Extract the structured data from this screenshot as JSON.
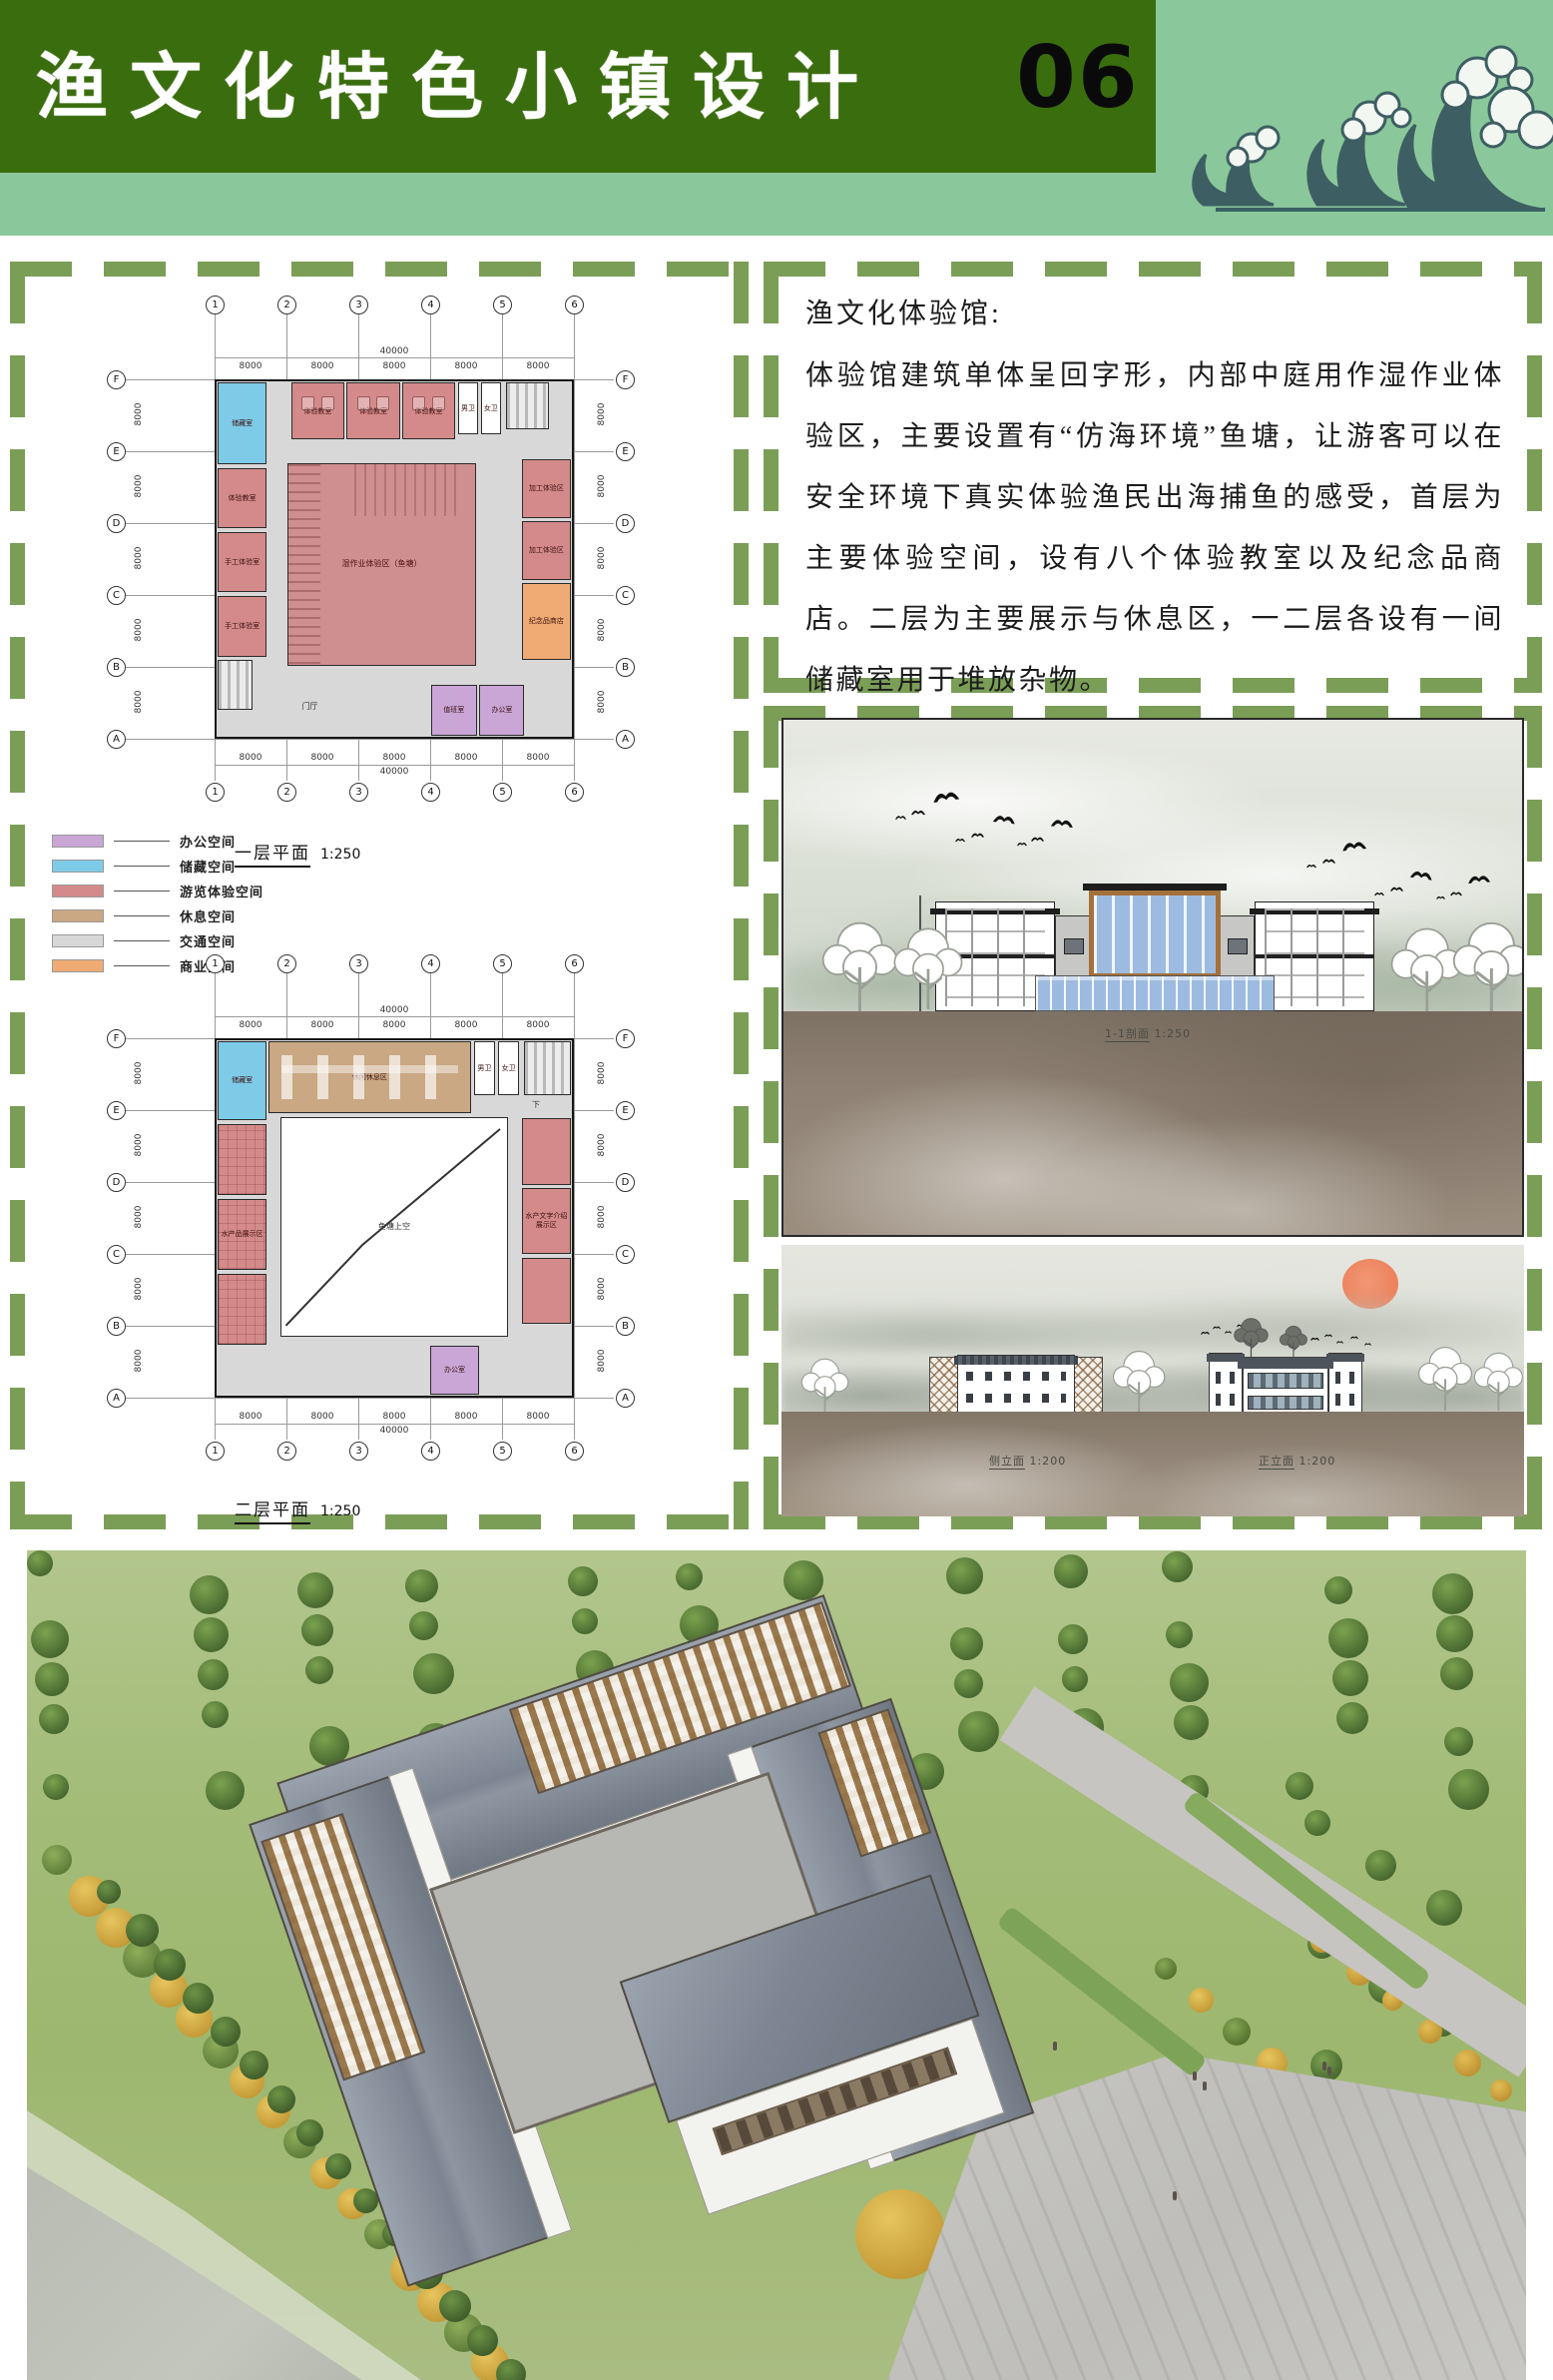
{
  "header": {
    "title": "渔文化特色小镇设计",
    "page_number": "06"
  },
  "colors": {
    "header_green": "#3a6d0e",
    "strip_green": "#8ac79a",
    "dash_green": "#7b9e57",
    "office": "#c9a6d6",
    "storage": "#7ecbe8",
    "tour": "#d48a8a",
    "rest": "#c9a883",
    "traffic": "#d8d8d8",
    "commerce": "#efab73",
    "pond": "#cf8e90",
    "wave_teal": "#3d5f63",
    "sun": "#ee7a52",
    "glass": "#9dbbe0",
    "wood": "#a4713c"
  },
  "left_panel": {
    "legend": {
      "items": [
        {
          "label": "办公空间",
          "type": "office"
        },
        {
          "label": "储藏空间",
          "type": "storage"
        },
        {
          "label": "游览体验空间",
          "type": "tour"
        },
        {
          "label": "休息空间",
          "type": "rest"
        },
        {
          "label": "交通空间",
          "type": "traffic"
        },
        {
          "label": "商业空间",
          "type": "commerce"
        }
      ]
    },
    "plans": [
      {
        "id": "plan1",
        "title": "一层平面",
        "scale": "1:250",
        "cols": [
          "1",
          "2",
          "3",
          "4",
          "5",
          "6"
        ],
        "rows": [
          "F",
          "E",
          "D",
          "C",
          "B",
          "A"
        ],
        "bay_dim": "8000",
        "total_dim": "40000",
        "extra_label": "门厅",
        "rooms": [
          {
            "x": 20,
            "y": 23,
            "w": 53,
            "h": 57,
            "type": "pond",
            "label": "湿作业体验区（鱼塘）"
          },
          {
            "x": 0.4,
            "y": 0.4,
            "w": 13.6,
            "h": 23,
            "type": "storage",
            "label": "储藏室"
          },
          {
            "x": 21,
            "y": 0.4,
            "w": 15,
            "h": 16,
            "type": "tour",
            "label": "体验教室",
            "cls": "classroom"
          },
          {
            "x": 36.6,
            "y": 0.4,
            "w": 15,
            "h": 16,
            "type": "tour",
            "label": "体验教室",
            "cls": "classroom"
          },
          {
            "x": 52.2,
            "y": 0.4,
            "w": 15,
            "h": 16,
            "type": "tour",
            "label": "体验教室",
            "cls": "classroom"
          },
          {
            "x": 68,
            "y": 0.4,
            "w": 5.6,
            "h": 14.6,
            "type": "wc",
            "label": "男卫"
          },
          {
            "x": 74.4,
            "y": 0.4,
            "w": 5.6,
            "h": 14.6,
            "type": "wc",
            "label": "女卫"
          },
          {
            "x": 81.4,
            "y": 0.4,
            "w": 12,
            "h": 13,
            "type": "stair",
            "label": ""
          },
          {
            "x": 0.4,
            "y": 24.4,
            "w": 13.6,
            "h": 17,
            "type": "tour",
            "label": "体验教室"
          },
          {
            "x": 0.4,
            "y": 42.4,
            "w": 13.6,
            "h": 17,
            "type": "tour",
            "label": "手工体验室"
          },
          {
            "x": 0.4,
            "y": 60.4,
            "w": 13.6,
            "h": 17,
            "type": "tour",
            "label": "手工体验室"
          },
          {
            "x": 0.4,
            "y": 78.4,
            "w": 9.6,
            "h": 14,
            "type": "stair",
            "label": ""
          },
          {
            "x": 86,
            "y": 22,
            "w": 13.6,
            "h": 16.4,
            "type": "tour",
            "label": "加工体验区"
          },
          {
            "x": 86,
            "y": 39.4,
            "w": 13.6,
            "h": 16.4,
            "type": "tour",
            "label": "加工体验区"
          },
          {
            "x": 86,
            "y": 56.8,
            "w": 13.6,
            "h": 21.6,
            "type": "commerce",
            "label": "纪念品商店"
          },
          {
            "x": 60.4,
            "y": 85.4,
            "w": 12.8,
            "h": 14.2,
            "type": "office",
            "label": "值班室"
          },
          {
            "x": 74,
            "y": 85.4,
            "w": 12.6,
            "h": 14.2,
            "type": "office",
            "label": "办公室"
          }
        ]
      },
      {
        "id": "plan2",
        "title": "二层平面",
        "scale": "1:250",
        "cols": [
          "1",
          "2",
          "3",
          "4",
          "5",
          "6"
        ],
        "rows": [
          "F",
          "E",
          "D",
          "C",
          "B",
          "A"
        ],
        "bay_dim": "8000",
        "total_dim": "40000",
        "extra_label": "下",
        "rooms": [
          {
            "x": 18,
            "y": 21.5,
            "w": 64,
            "h": 62,
            "type": "void",
            "label": "鱼塘上空",
            "diag": true
          },
          {
            "x": 0.4,
            "y": 0.4,
            "w": 13.6,
            "h": 22,
            "type": "storage",
            "label": "储藏室"
          },
          {
            "x": 14.6,
            "y": 0.4,
            "w": 57,
            "h": 20,
            "type": "rest",
            "label": "休闲休息区"
          },
          {
            "x": 72.4,
            "y": 0.4,
            "w": 6,
            "h": 15,
            "type": "wc",
            "label": "男卫"
          },
          {
            "x": 79.2,
            "y": 0.4,
            "w": 6,
            "h": 15,
            "type": "wc",
            "label": "女卫"
          },
          {
            "x": 86.4,
            "y": 0.4,
            "w": 13.2,
            "h": 15,
            "type": "stair",
            "label": ""
          },
          {
            "x": 0.4,
            "y": 23.6,
            "w": 13.6,
            "h": 20,
            "type": "tour",
            "label": "",
            "cls": "hatch"
          },
          {
            "x": 0.4,
            "y": 44.6,
            "w": 13.6,
            "h": 20,
            "type": "tour",
            "label": "水产品展示区",
            "cls": "hatch"
          },
          {
            "x": 0.4,
            "y": 65.6,
            "w": 13.6,
            "h": 20,
            "type": "tour",
            "label": "",
            "cls": "hatch"
          },
          {
            "x": 86,
            "y": 22,
            "w": 13.6,
            "h": 18.6,
            "type": "tour",
            "label": ""
          },
          {
            "x": 86,
            "y": 41.6,
            "w": 13.6,
            "h": 18.6,
            "type": "tour",
            "label": "水产文字介绍展示区"
          },
          {
            "x": 86,
            "y": 61.2,
            "w": 13.6,
            "h": 18.6,
            "type": "tour",
            "label": ""
          },
          {
            "x": 60,
            "y": 86,
            "w": 14,
            "h": 13.6,
            "type": "office",
            "label": "办公室"
          }
        ]
      }
    ]
  },
  "right_top_panel": {
    "heading": "渔文化体验馆:",
    "body": "体验馆建筑单体呈回字形，内部中庭用作湿作业体验区，主要设置有“仿海环境”鱼塘，让游客可以在安全环境下真实体验渔民出海捕鱼的感受，首层为主要体验空间，设有八个体验教室以及纪念品商店。二层为主要展示与休息区，一二层各设有一间储藏室用于堆放杂物。"
  },
  "right_bottom_panel": {
    "elevation1_label": "1-1剖面",
    "elevation1_scale": "1:250",
    "elevation2_left_label": "侧立面",
    "elevation2_left_scale": "1:200",
    "elevation2_right_label": "正立面",
    "elevation2_right_scale": "1:200"
  }
}
